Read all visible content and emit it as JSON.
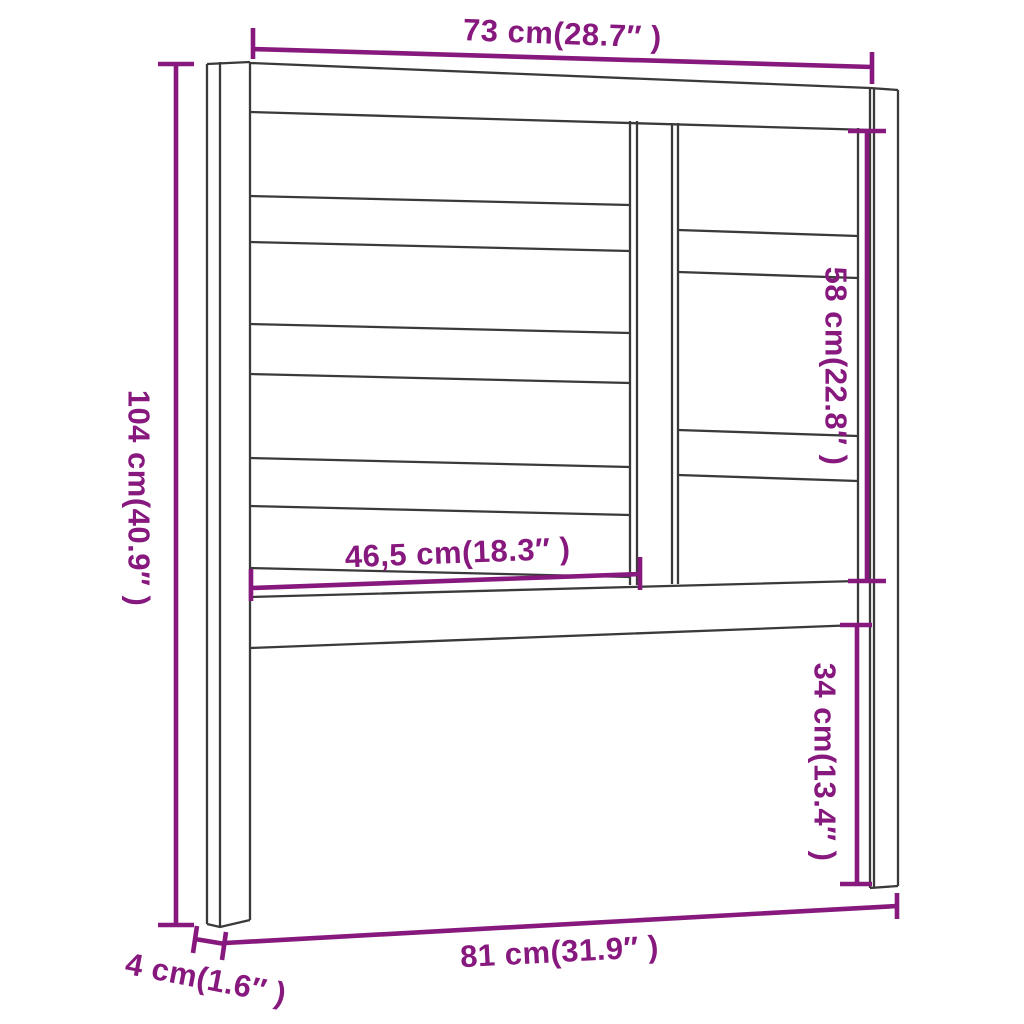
{
  "diagram": {
    "title": "Headboard dimension drawing",
    "colors": {
      "dimension": "#87187E",
      "line": "#3a3a3a",
      "background": "#ffffff"
    },
    "dimensions": {
      "top_width": "73 cm(28.7″ )",
      "left_height": "104 cm(40.9″ )",
      "right_upper_height": "58 cm(22.8″ )",
      "inner_width": "46,5 cm(18.3″ )",
      "right_lower_height": "34 cm(13.4″ )",
      "post_depth": "4 cm(1.6″ )",
      "bottom_width": "81 cm(31.9″ )"
    }
  }
}
